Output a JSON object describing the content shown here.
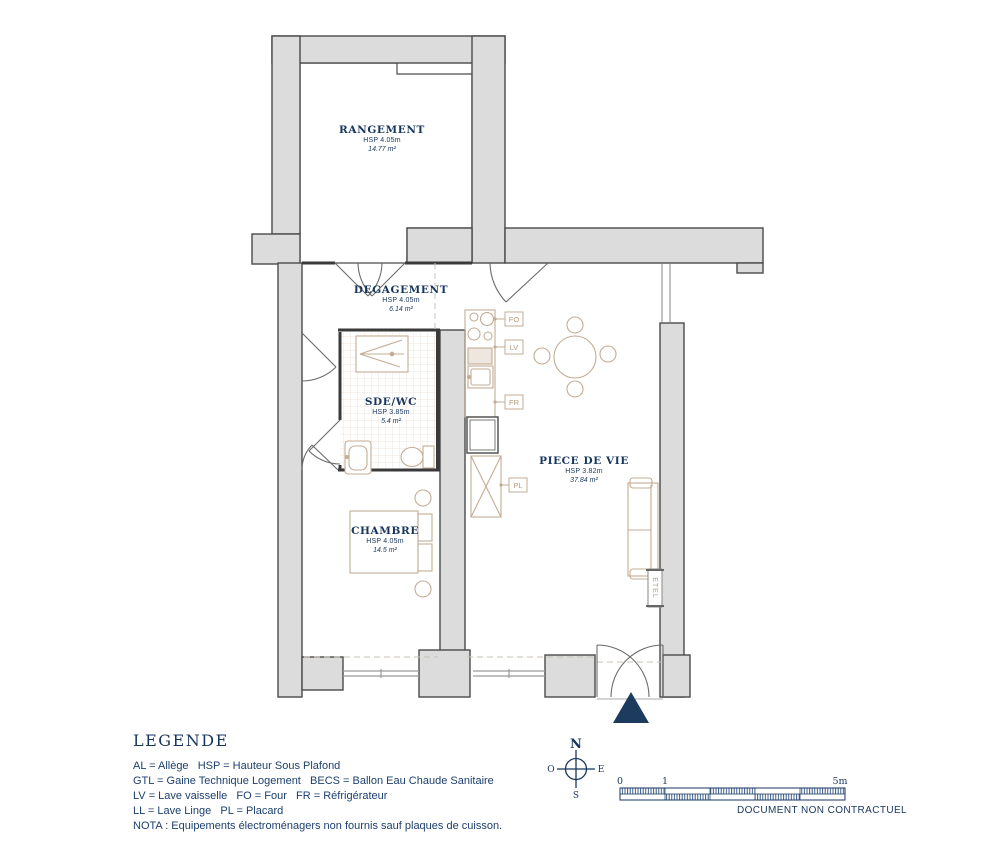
{
  "plan": {
    "rooms": [
      {
        "name": "RANGEMENT",
        "hsp": "HSP 4.05m",
        "area": "14.77 m²"
      },
      {
        "name": "DEGAGEMENT",
        "hsp": "HSP 4.05m",
        "area": "6.14 m²"
      },
      {
        "name": "SDE/WC",
        "hsp": "HSP 3.85m",
        "area": "5.4 m²"
      },
      {
        "name": "CHAMBRE",
        "hsp": "HSP 4.05m",
        "area": "14.5 m²"
      },
      {
        "name": "PIECE DE VIE",
        "hsp": "HSP 3.82m",
        "area": "37.84 m²"
      }
    ],
    "tags": {
      "four": "FO",
      "lave_vaisselle": "LV",
      "refrigerateur": "FR",
      "placard": "PL",
      "radiateur": "ETEL"
    }
  },
  "legend": {
    "title": "LEGENDE",
    "lines": [
      "AL = Allège   HSP = Hauteur Sous Plafond",
      "GTL = Gaine Technique Logement   BECS = Ballon Eau Chaude Sanitaire",
      "LV = Lave vaisselle   FO = Four   FR = Réfrigérateur",
      "LL = Lave Linge   PL = Placard",
      "NOTA : Equipements électroménagers non fournis sauf plaques de cuisson."
    ]
  },
  "compass": {
    "north": "N",
    "south": "S",
    "east": "E",
    "west": "O"
  },
  "scalebar": {
    "start": "0",
    "mid": "1",
    "end": "5m"
  },
  "footer": {
    "disclaimer": "DOCUMENT NON CONTRACTUEL"
  },
  "colors": {
    "label_navy": "#17365d",
    "wall_fill": "#dcdcdc",
    "wall_line": "#4a4a4a",
    "furniture_tan": "#c3ac94",
    "triangle_navy": "#1d3a5f"
  }
}
